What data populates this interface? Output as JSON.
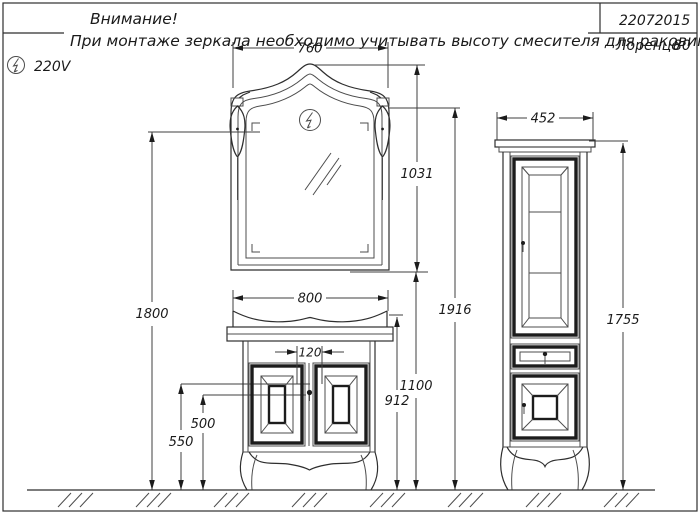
{
  "note": {
    "line1": "Внимание!",
    "line2": "При монтаже зеркала необходимо учитывать высоту смесителя для раковины!"
  },
  "title_block": {
    "doc_number": "22072015",
    "model_name": "Лоренцо",
    "model_size": "80"
  },
  "power": {
    "voltage": "220V",
    "icon": "lightning-circle"
  },
  "dims": {
    "mirror_width": "760",
    "mirror_height": "1031",
    "sconce_height": "1800",
    "total_height": "1916",
    "mirror_bottom_height": "1100",
    "vanity_width": "800",
    "knob_spacing": "120",
    "countertop_height": "912",
    "knob_height_inner": "500",
    "knob_height_outer": "550",
    "cabinet_width": "452",
    "cabinet_height": "1755"
  },
  "colors": {
    "line": "#3f3f3f",
    "dark": "#1c1c1c",
    "text": "#1a1a1a",
    "background": "#ffffff"
  }
}
